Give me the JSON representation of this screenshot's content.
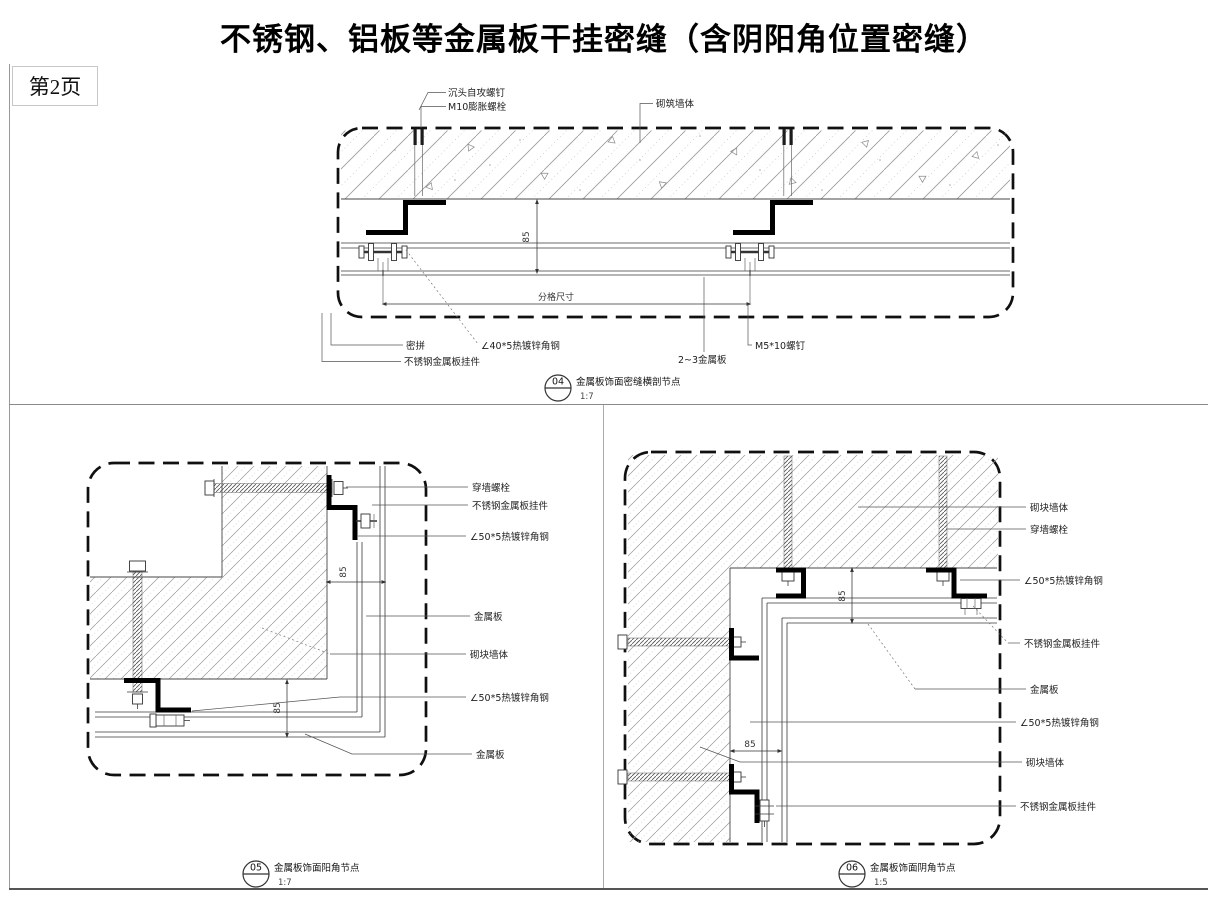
{
  "sheet": {
    "title": "不锈钢、铝板等金属板干挂密缝（含阴阳角位置密缝）",
    "page_label": "第2页"
  },
  "details": [
    {
      "number": "04",
      "name": "金属板饰面密缝横剖节点",
      "scale": "1:7",
      "labels": {
        "screw": "沉头自攻螺钉",
        "anchor": "M10膨胀螺栓",
        "wall": "砌筑墙体",
        "seam": "密拼",
        "angle": "∠40*5热镀锌角钢",
        "hanger": "不锈钢金属板挂件",
        "bolt": "M5*10螺钉",
        "panel": "2~3金属板",
        "dim_height": "85",
        "dim_grid": "分格尺寸"
      }
    },
    {
      "number": "05",
      "name": "金属板饰面阳角节点",
      "scale": "1:7",
      "labels": {
        "anchor": "穿墙螺栓",
        "hanger": "不锈钢金属板挂件",
        "angle_top": "∠50*5热镀锌角钢",
        "panel_top": "金属板",
        "wall": "砌块墙体",
        "angle_bottom": "∠50*5热镀锌角钢",
        "panel_bottom": "金属板",
        "dim_side": "85",
        "dim_bottom": "85"
      }
    },
    {
      "number": "06",
      "name": "金属板饰面阴角节点",
      "scale": "1:5",
      "labels": {
        "wall_top": "砌块墙体",
        "anchor": "穿墙螺栓",
        "angle_top": "∠50*5热镀锌角钢",
        "hanger_top": "不锈钢金属板挂件",
        "panel": "金属板",
        "angle_bottom": "∠50*5热镀锌角钢",
        "wall_bottom": "砌块墙体",
        "hanger_bottom": "不锈钢金属板挂件",
        "dim_top": "85",
        "dim_bottom": "85"
      }
    }
  ],
  "colors": {
    "line": "#333333",
    "thick_steel": "#000000",
    "hatch": "#9a9a9a",
    "frame": "#999999"
  }
}
